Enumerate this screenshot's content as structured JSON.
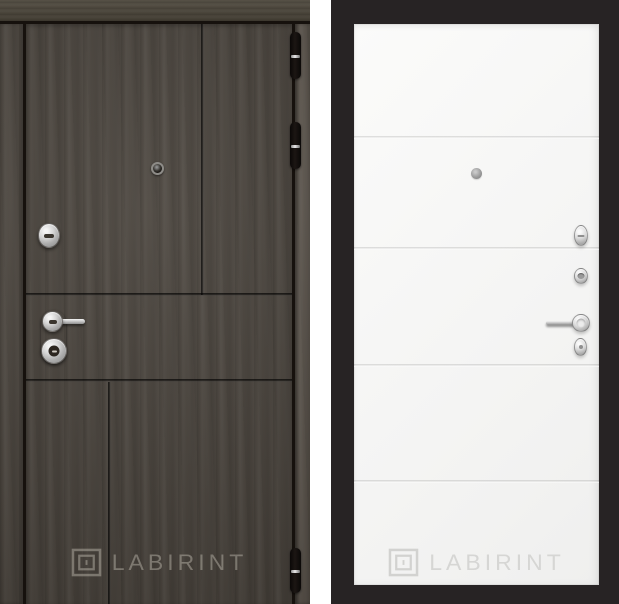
{
  "brand": {
    "watermark_text": "LABIRINT",
    "logo_icon": "labyrinth-maze-icon"
  },
  "left_panel": {
    "name": "entry-door-exterior-side",
    "finish": "dark wenge wood",
    "colors": {
      "wood": "#4b453e",
      "grooves": "#1d1811",
      "frame_gap": "#16110d"
    },
    "watermark_text": "LABIRINT",
    "hardware": {
      "peephole": "peephole",
      "upper_lock": "oval cylinder escutcheon",
      "handle": "lever handle on dark backplate",
      "lower_lock": "round keyhole cylinder",
      "hinges_visible": 3
    }
  },
  "right_panel": {
    "name": "entry-door-interior-side",
    "finish": "white flat panel with 4 horizontal molding lines",
    "colors": {
      "background": "#272324",
      "face": "#f6f6f5",
      "molding_lines": "#d3d3d1"
    },
    "watermark_text": "LABIRINT",
    "molding_lines_count": 4,
    "hardware": {
      "peephole": "peephole",
      "thumbturn": "night-latch thumbturn knob",
      "cylinder": "key cylinder",
      "handle": "lever handle with round rose",
      "escutcheon": "oval escutcheon"
    }
  }
}
